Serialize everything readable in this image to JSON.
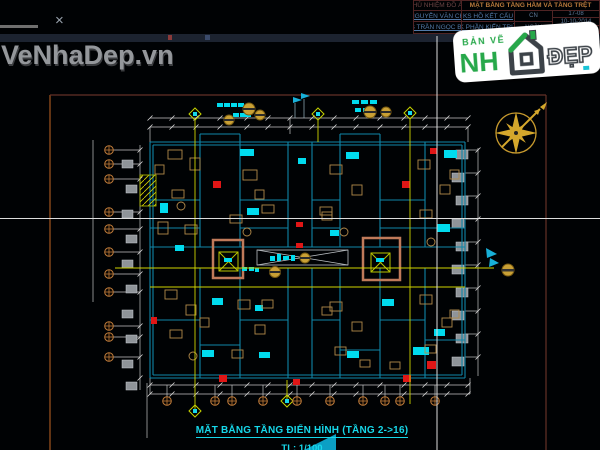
{
  "watermark": {
    "text": "VeNhaDep.vn"
  },
  "chrome": {
    "close_glyph": "×"
  },
  "title_block": {
    "row1_left": "CHỦ NHIỆM ĐỒ ÁN",
    "row1_title": "MẶT BẰNG TẦNG HẦM VÀ TẦNG TRỆT",
    "r2c1": "KS NGUYỄN VĂN CHÍNH",
    "r2c2": "KS HỒ KẾT CẤU",
    "r2c3": "CN",
    "r3c1": "KTS TRẦN NGỌC BÌNH",
    "r3c2": "TK PHẦN KIẾN TRÚC",
    "r3c3": "NGÀY",
    "side1": "17-08",
    "side2": "10-10-2014",
    "side3": "NĐT 4C"
  },
  "logo": {
    "prefix": "BẢN VẼ",
    "nha": "NH",
    "dep": "ĐẸP"
  },
  "plan": {
    "caption": "MẶT BẰNG TẦNG ĐIỂN HÌNH (TẦNG 2->16)",
    "scale": "TL: 1/100"
  },
  "colors": {
    "cad_cyan": "#00dbee",
    "cad_red": "#e01616",
    "cad_yellow": "#cfd400",
    "cad_tan": "#b28a4a",
    "grid_orange": "#c07c3a",
    "sheet_border": "#a2561f",
    "caption_cyan": "#17d8ea",
    "logo_green": "#27a84a",
    "logo_gray": "#3c4248",
    "title_tan": "#b87a3c",
    "table_blue": "#527aa8",
    "compass_gold": "#d4a72c"
  },
  "plan_geometry": {
    "walls": [
      [
        150,
        142,
        465,
        142
      ],
      [
        465,
        142,
        465,
        378
      ],
      [
        465,
        378,
        150,
        378
      ],
      [
        150,
        378,
        150,
        142
      ],
      [
        153,
        145,
        462,
        145
      ],
      [
        462,
        145,
        462,
        375
      ],
      [
        462,
        375,
        153,
        375
      ],
      [
        153,
        145,
        153,
        375
      ],
      [
        150,
        247,
        465,
        247
      ],
      [
        150,
        268,
        465,
        268
      ],
      [
        288,
        142,
        288,
        247
      ],
      [
        312,
        142,
        312,
        247
      ],
      [
        288,
        268,
        288,
        378
      ],
      [
        312,
        268,
        312,
        378
      ],
      [
        200,
        142,
        200,
        247
      ],
      [
        240,
        142,
        240,
        247
      ],
      [
        340,
        142,
        340,
        247
      ],
      [
        380,
        142,
        380,
        247
      ],
      [
        425,
        142,
        425,
        247
      ],
      [
        200,
        268,
        200,
        378
      ],
      [
        240,
        268,
        240,
        378
      ],
      [
        340,
        268,
        340,
        378
      ],
      [
        380,
        268,
        380,
        378
      ],
      [
        425,
        268,
        425,
        378
      ],
      [
        150,
        200,
        200,
        200
      ],
      [
        240,
        200,
        288,
        200
      ],
      [
        312,
        200,
        340,
        200
      ],
      [
        380,
        200,
        425,
        200
      ],
      [
        150,
        228,
        200,
        228
      ],
      [
        240,
        228,
        288,
        228
      ],
      [
        312,
        228,
        340,
        228
      ],
      [
        380,
        228,
        425,
        228
      ],
      [
        425,
        228,
        465,
        228
      ],
      [
        150,
        320,
        200,
        320
      ],
      [
        240,
        320,
        288,
        320
      ],
      [
        312,
        320,
        340,
        320
      ],
      [
        380,
        320,
        425,
        320
      ],
      [
        425,
        340,
        465,
        340
      ],
      [
        200,
        345,
        240,
        345
      ],
      [
        340,
        350,
        380,
        350
      ],
      [
        200,
        134,
        240,
        134
      ],
      [
        200,
        134,
        200,
        142
      ],
      [
        240,
        134,
        240,
        142
      ],
      [
        340,
        134,
        380,
        134
      ],
      [
        340,
        134,
        340,
        142
      ],
      [
        380,
        134,
        380,
        142
      ]
    ],
    "dims": [
      [
        150,
        118,
        468,
        118
      ],
      [
        150,
        127,
        468,
        127
      ],
      [
        150,
        385,
        470,
        385
      ],
      [
        150,
        394,
        470,
        394
      ],
      [
        140,
        145,
        140,
        390
      ],
      [
        93,
        140,
        93,
        302
      ],
      [
        478,
        148,
        478,
        376
      ],
      [
        150,
        127,
        150,
        142
      ],
      [
        468,
        127,
        468,
        142
      ],
      [
        290,
        118,
        290,
        134
      ],
      [
        150,
        378,
        150,
        394
      ],
      [
        470,
        378,
        470,
        394
      ],
      [
        147,
        383,
        147,
        438
      ],
      [
        113,
        150,
        140,
        150
      ],
      [
        113,
        164,
        140,
        164
      ],
      [
        113,
        179,
        140,
        179
      ],
      [
        113,
        212,
        140,
        212
      ],
      [
        113,
        229,
        140,
        229
      ],
      [
        113,
        252,
        140,
        252
      ],
      [
        113,
        274,
        140,
        274
      ],
      [
        113,
        292,
        140,
        292
      ],
      [
        113,
        326,
        140,
        326
      ],
      [
        113,
        337,
        140,
        337
      ],
      [
        113,
        357,
        140,
        357
      ],
      [
        465,
        150,
        478,
        150
      ],
      [
        465,
        173,
        478,
        173
      ],
      [
        465,
        196,
        478,
        196
      ],
      [
        465,
        219,
        478,
        219
      ],
      [
        465,
        242,
        478,
        242
      ],
      [
        465,
        265,
        478,
        265
      ],
      [
        465,
        288,
        478,
        288
      ],
      [
        465,
        311,
        478,
        311
      ],
      [
        465,
        334,
        478,
        334
      ],
      [
        465,
        357,
        478,
        357
      ],
      [
        167,
        385,
        167,
        397
      ],
      [
        215,
        385,
        215,
        397
      ],
      [
        232,
        385,
        232,
        397
      ],
      [
        263,
        385,
        263,
        397
      ],
      [
        297,
        385,
        297,
        397
      ],
      [
        330,
        385,
        330,
        397
      ],
      [
        363,
        385,
        363,
        397
      ],
      [
        385,
        385,
        385,
        397
      ],
      [
        400,
        385,
        400,
        397
      ],
      [
        435,
        385,
        435,
        397
      ]
    ],
    "ticks": {
      "rows": [
        {
          "y": 118,
          "xs": [
            150,
            172,
            196,
            220,
            247,
            268,
            290,
            312,
            334,
            356,
            380,
            404,
            425,
            447,
            468
          ]
        },
        {
          "y": 127,
          "xs": [
            150,
            172,
            196,
            220,
            247,
            268,
            290,
            312,
            334,
            356,
            380,
            404,
            425,
            447,
            468
          ]
        },
        {
          "y": 385,
          "xs": [
            150,
            172,
            196,
            220,
            247,
            268,
            290,
            312,
            334,
            356,
            380,
            404,
            425,
            447,
            468
          ]
        },
        {
          "y": 394,
          "xs": [
            150,
            172,
            196,
            220,
            247,
            268,
            290,
            312,
            334,
            356,
            380,
            404,
            425,
            447,
            468
          ]
        }
      ],
      "cols": [
        {
          "x": 140,
          "ys": [
            150,
            164,
            179,
            212,
            229,
            252,
            274,
            292,
            326,
            337,
            357,
            378
          ]
        },
        {
          "x": 478,
          "ys": [
            150,
            173,
            196,
            219,
            242,
            265,
            288,
            311,
            334,
            357
          ]
        }
      ]
    },
    "yellow_lines": [
      [
        115,
        268,
        494,
        268
      ],
      [
        150,
        287,
        465,
        287
      ],
      [
        195,
        120,
        195,
        412
      ],
      [
        410,
        119,
        410,
        404
      ],
      [
        318,
        120,
        318,
        142
      ],
      [
        287,
        380,
        287,
        403
      ]
    ],
    "diamonds": [
      [
        195,
        114
      ],
      [
        318,
        114
      ],
      [
        410,
        113
      ],
      [
        195,
        411
      ],
      [
        287,
        401
      ]
    ],
    "gold_circles": [
      [
        249,
        109,
        6
      ],
      [
        229,
        120,
        5
      ],
      [
        260,
        115,
        5
      ],
      [
        370,
        112,
        6
      ],
      [
        386,
        112,
        5
      ],
      [
        305,
        258,
        5
      ],
      [
        275,
        272,
        5.5
      ]
    ],
    "cyan_fills": [
      [
        217,
        103,
        6,
        4
      ],
      [
        224,
        103,
        6,
        4
      ],
      [
        231,
        103,
        6,
        4
      ],
      [
        238,
        103,
        6,
        4
      ],
      [
        233,
        113,
        6,
        4
      ],
      [
        240,
        113,
        6,
        4
      ],
      [
        246,
        113,
        5,
        4
      ],
      [
        352,
        100,
        7,
        4
      ],
      [
        361,
        100,
        7,
        4
      ],
      [
        370,
        100,
        7,
        4
      ],
      [
        355,
        108,
        6,
        4
      ],
      [
        363,
        108,
        6,
        4
      ],
      [
        240,
        149,
        14,
        7
      ],
      [
        346,
        152,
        13,
        7
      ],
      [
        444,
        150,
        13,
        8
      ],
      [
        247,
        208,
        12,
        7
      ],
      [
        437,
        224,
        13,
        8
      ],
      [
        160,
        203,
        8,
        10
      ],
      [
        212,
        298,
        11,
        7
      ],
      [
        382,
        299,
        12,
        7
      ],
      [
        202,
        350,
        12,
        7
      ],
      [
        259,
        352,
        11,
        6
      ],
      [
        347,
        351,
        12,
        7
      ],
      [
        434,
        329,
        11,
        7
      ],
      [
        413,
        347,
        16,
        8
      ],
      [
        298,
        158,
        8,
        6
      ],
      [
        255,
        305,
        8,
        6
      ],
      [
        330,
        230,
        9,
        6
      ],
      [
        175,
        245,
        9,
        6
      ],
      [
        270,
        256,
        5,
        5
      ],
      [
        277,
        254,
        4,
        7
      ],
      [
        283,
        256,
        6,
        4
      ],
      [
        291,
        255,
        4,
        6
      ],
      [
        242,
        267,
        5,
        4
      ],
      [
        249,
        267,
        5,
        4
      ],
      [
        255,
        268,
        4,
        4
      ],
      [
        224,
        258,
        8,
        4
      ],
      [
        376,
        258,
        8,
        4
      ]
    ],
    "red_fills": [
      [
        213,
        181,
        8,
        7
      ],
      [
        402,
        181,
        8,
        7
      ],
      [
        219,
        375,
        8,
        7
      ],
      [
        403,
        375,
        8,
        7
      ],
      [
        430,
        148,
        7,
        6
      ],
      [
        427,
        361,
        9,
        8
      ],
      [
        296,
        222,
        7,
        5
      ],
      [
        296,
        243,
        7,
        5
      ],
      [
        151,
        317,
        6,
        7
      ],
      [
        293,
        379,
        7,
        6
      ]
    ],
    "furniture_rects": [
      [
        168,
        150,
        14,
        9
      ],
      [
        190,
        158,
        10,
        12
      ],
      [
        172,
        190,
        12,
        8
      ],
      [
        158,
        222,
        10,
        12
      ],
      [
        185,
        225,
        12,
        9
      ],
      [
        243,
        170,
        14,
        10
      ],
      [
        255,
        190,
        9,
        9
      ],
      [
        230,
        215,
        12,
        8
      ],
      [
        330,
        165,
        12,
        9
      ],
      [
        352,
        185,
        10,
        10
      ],
      [
        320,
        207,
        12,
        8
      ],
      [
        418,
        160,
        12,
        9
      ],
      [
        440,
        185,
        10,
        9
      ],
      [
        420,
        210,
        12,
        8
      ],
      [
        165,
        290,
        12,
        9
      ],
      [
        186,
        305,
        10,
        10
      ],
      [
        170,
        330,
        12,
        8
      ],
      [
        200,
        318,
        9,
        9
      ],
      [
        238,
        300,
        12,
        9
      ],
      [
        255,
        325,
        10,
        9
      ],
      [
        232,
        350,
        11,
        8
      ],
      [
        330,
        302,
        12,
        9
      ],
      [
        352,
        322,
        10,
        9
      ],
      [
        335,
        347,
        11,
        8
      ],
      [
        420,
        295,
        12,
        9
      ],
      [
        442,
        318,
        10,
        9
      ],
      [
        425,
        345,
        11,
        8
      ],
      [
        262,
        205,
        12,
        8
      ],
      [
        322,
        212,
        10,
        8
      ],
      [
        262,
        300,
        11,
        8
      ],
      [
        322,
        307,
        10,
        8
      ],
      [
        360,
        360,
        10,
        7
      ],
      [
        390,
        362,
        10,
        7
      ],
      [
        155,
        165,
        9,
        9
      ],
      [
        450,
        170,
        9,
        9
      ],
      [
        450,
        310,
        9,
        8
      ]
    ],
    "furniture_circles": [
      [
        181,
        206,
        4
      ],
      [
        247,
        232,
        4
      ],
      [
        344,
        232,
        4
      ],
      [
        431,
        242,
        4
      ],
      [
        193,
        356,
        4
      ]
    ],
    "slabs": [
      [
        456,
        150,
        12,
        9
      ],
      [
        452,
        173,
        12,
        9
      ],
      [
        456,
        196,
        12,
        9
      ],
      [
        452,
        219,
        12,
        9
      ],
      [
        456,
        242,
        12,
        9
      ],
      [
        452,
        265,
        12,
        9
      ],
      [
        456,
        288,
        12,
        9
      ],
      [
        452,
        311,
        12,
        9
      ],
      [
        456,
        334,
        12,
        9
      ],
      [
        452,
        357,
        12,
        9
      ],
      [
        122,
        160,
        11,
        8
      ],
      [
        126,
        185,
        11,
        8
      ],
      [
        122,
        210,
        11,
        8
      ],
      [
        126,
        235,
        11,
        8
      ],
      [
        122,
        260,
        11,
        8
      ],
      [
        126,
        285,
        11,
        8
      ],
      [
        122,
        310,
        11,
        8
      ],
      [
        126,
        335,
        11,
        8
      ],
      [
        122,
        360,
        11,
        8
      ],
      [
        126,
        382,
        11,
        8
      ]
    ],
    "grid_bubbles": [
      [
        109,
        150
      ],
      [
        109,
        164
      ],
      [
        109,
        179
      ],
      [
        109,
        212
      ],
      [
        109,
        229
      ],
      [
        109,
        252
      ],
      [
        109,
        274
      ],
      [
        109,
        292
      ],
      [
        109,
        326
      ],
      [
        109,
        337
      ],
      [
        109,
        357
      ],
      [
        167,
        401
      ],
      [
        215,
        401
      ],
      [
        232,
        401
      ],
      [
        263,
        401
      ],
      [
        297,
        401
      ],
      [
        330,
        401
      ],
      [
        363,
        401
      ],
      [
        385,
        401
      ],
      [
        400,
        401
      ],
      [
        435,
        401
      ]
    ]
  }
}
